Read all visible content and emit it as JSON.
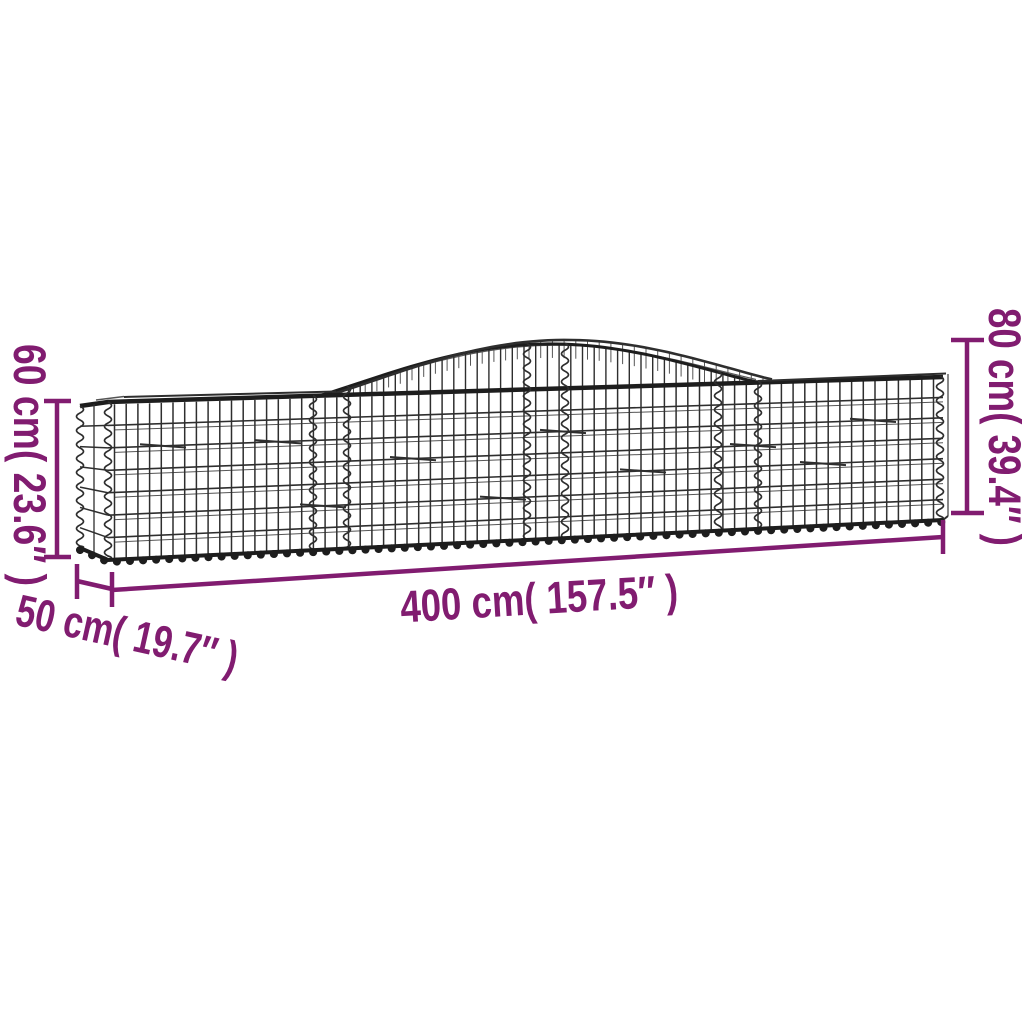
{
  "image": {
    "kind": "product-dimension-diagram",
    "subject": "arched gabion wire mesh basket",
    "background": "#ffffff"
  },
  "colors": {
    "accent": "#811c70",
    "wire": "#2e2e2e",
    "wire_light": "#555555",
    "wire_dark": "#1d1d1d"
  },
  "dimensions": {
    "end_height": {
      "label": "60 cm( 23.6″ )",
      "cm": 60,
      "inches": 23.6,
      "position": "left",
      "orientation": "vertical"
    },
    "peak_height": {
      "label": "80 cm( 39.4″ )",
      "cm": 80,
      "inches": 39.4,
      "position": "right",
      "orientation": "vertical"
    },
    "length": {
      "label": "400 cm( 157.5″ )",
      "cm": 400,
      "inches": 157.5,
      "position": "bottom",
      "orientation": "horizontal"
    },
    "depth": {
      "label": "50 cm( 19.7″ )",
      "cm": 50,
      "inches": 19.7,
      "position": "bottom-left",
      "orientation": "diagonal"
    }
  }
}
